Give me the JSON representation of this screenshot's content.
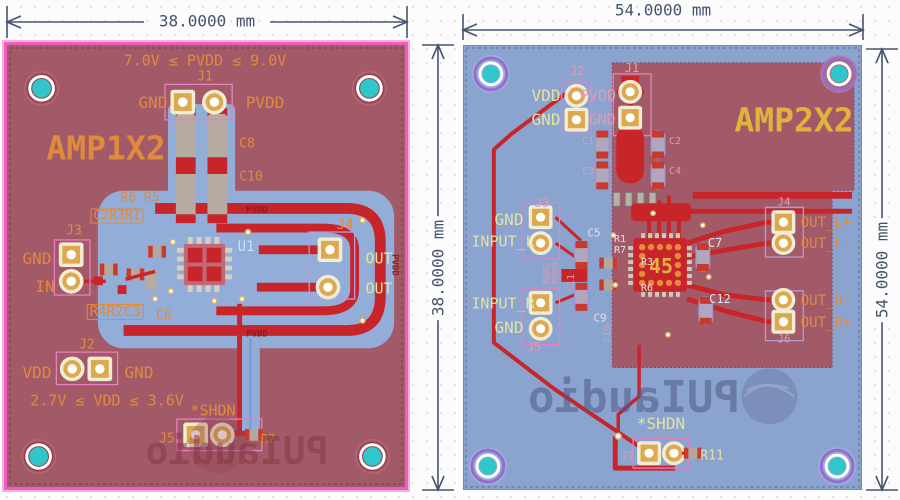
{
  "app": {
    "type": "pcb-layout-viewer"
  },
  "colors": {
    "board_red": "#a35a68",
    "board_blue": "#8ba3cf",
    "outline_pink": "#ee5ec2",
    "copper_red": "#c8252b",
    "pour_blue": "#93add9",
    "hole_teal": "#2fc7c9",
    "ring_purple": "#9a6ad0",
    "pad_gold": "#dca94f",
    "pad_ring": "#f2ecd6",
    "silk_orange": "#e08a3e",
    "silk_yellow": "#e3e3a2",
    "silk_pink": "#dc9cb4",
    "silk_pale": "#e2e2e6",
    "silk_gold": "#e2b23f",
    "net_red": "#8c1d22",
    "dim": "#44546e",
    "logo_left": "rgba(130,52,64,0.5)",
    "logo_right": "rgba(78,90,130,0.55)"
  },
  "logo": {
    "text": "PUIaudio"
  },
  "left_board": {
    "title": "AMP1X2",
    "width_label": "38.0000 mm",
    "height_label": "38.0000 mm",
    "labels": [
      {
        "name": "silk-pvdd-range",
        "text": "7.0V ≤ PVDD ≤ 9.0V",
        "x": 198,
        "y": 16,
        "cls": "silk-orange",
        "size": 15
      },
      {
        "name": "silk-j1",
        "text": "J1",
        "x": 198,
        "y": 32,
        "cls": "silk-orange",
        "size": 13
      },
      {
        "name": "silk-j1-gnd",
        "text": "GND",
        "x": 146,
        "y": 58,
        "cls": "silk-orange",
        "size": 16
      },
      {
        "name": "silk-j1-pvdd",
        "text": "PVDD",
        "x": 258,
        "y": 58,
        "cls": "silk-orange",
        "size": 16
      },
      {
        "name": "silk-c8",
        "text": "C8",
        "x": 240,
        "y": 99,
        "cls": "silk-orange",
        "size": 13
      },
      {
        "name": "silk-c10",
        "text": "C10",
        "x": 244,
        "y": 132,
        "cls": "silk-orange",
        "size": 13
      },
      {
        "name": "board-title",
        "text": "AMP1X2",
        "x": 99,
        "y": 103,
        "cls": "silk-orange",
        "size": 33,
        "bold": true
      },
      {
        "name": "silk-r6-r5",
        "text": "R6 R5",
        "x": 133,
        "y": 153,
        "cls": "silk-orange",
        "size": 13
      },
      {
        "name": "silk-c2r3r1",
        "text": "C2R3R1",
        "x": 110,
        "y": 171,
        "cls": "silk-orange",
        "size": 13,
        "box": true
      },
      {
        "name": "silk-j3",
        "text": "J3",
        "x": 67,
        "y": 186,
        "cls": "silk-orange",
        "size": 13
      },
      {
        "name": "silk-j3-gnd",
        "text": "GND",
        "x": 30,
        "y": 214,
        "cls": "silk-orange",
        "size": 16
      },
      {
        "name": "silk-j3-in",
        "text": "IN",
        "x": 38,
        "y": 242,
        "cls": "silk-orange",
        "size": 16
      },
      {
        "name": "silk-r4r2c3",
        "text": "R4R2C3",
        "x": 108,
        "y": 267,
        "cls": "silk-orange",
        "size": 14,
        "box": true
      },
      {
        "name": "silk-c6",
        "text": "C6",
        "x": 157,
        "y": 271,
        "cls": "silk-orange",
        "size": 13
      },
      {
        "name": "silk-u1",
        "text": "U1",
        "x": 239,
        "y": 202,
        "cls": "silk-blue",
        "size": 14
      },
      {
        "name": "silk-j4",
        "text": "J4",
        "x": 338,
        "y": 180,
        "cls": "silk-orange",
        "size": 14
      },
      {
        "name": "silk-out-1",
        "text": "OUT",
        "x": 372,
        "y": 214,
        "cls": "silk-yellow",
        "size": 15
      },
      {
        "name": "silk-out-2",
        "text": "OUT",
        "x": 372,
        "y": 244,
        "cls": "silk-yellow",
        "size": 15
      },
      {
        "name": "net-pvdd-top",
        "text": "PVDD",
        "x": 250,
        "y": 166,
        "cls": "silk-net",
        "size": 9
      },
      {
        "name": "net-pvdd-bottom",
        "text": "PVDD",
        "x": 250,
        "y": 290,
        "cls": "silk-net",
        "size": 9
      },
      {
        "name": "net-pvdd-right",
        "text": "PVDD",
        "x": 387,
        "y": 220,
        "cls": "silk-net",
        "size": 9,
        "rot": 90
      },
      {
        "name": "silk-j2",
        "text": "J2",
        "x": 80,
        "y": 300,
        "cls": "silk-orange",
        "size": 13
      },
      {
        "name": "silk-j2-vdd",
        "text": "VDD",
        "x": 30,
        "y": 328,
        "cls": "silk-orange",
        "size": 16
      },
      {
        "name": "silk-j2-gnd",
        "text": "GND",
        "x": 132,
        "y": 328,
        "cls": "silk-orange",
        "size": 16
      },
      {
        "name": "silk-vdd-range",
        "text": "2.7V ≤ VDD ≤ 3.6V",
        "x": 100,
        "y": 356,
        "cls": "silk-orange",
        "size": 15
      },
      {
        "name": "silk-shdn",
        "text": "*SHDN",
        "x": 206,
        "y": 366,
        "cls": "silk-orange",
        "size": 15
      },
      {
        "name": "silk-j5",
        "text": "J5",
        "x": 160,
        "y": 394,
        "cls": "silk-orange",
        "size": 13
      },
      {
        "name": "silk-r7",
        "text": "R7",
        "x": 261,
        "y": 394,
        "cls": "silk-orange",
        "size": 12
      },
      {
        "name": "logo-text",
        "text": "PUIaudio",
        "x": 230,
        "y": 406,
        "cls": "logo-left",
        "size": 38,
        "bold": true,
        "mirror": true
      }
    ]
  },
  "right_board": {
    "title": "AMP2X2",
    "width_label": "54.0000 mm",
    "height_label": "54.0000 mm",
    "labels": [
      {
        "name": "silk-j2",
        "text": "J2",
        "x": 113,
        "y": 25,
        "cls": "silk-pink",
        "size": 12
      },
      {
        "name": "silk-j2-vdd",
        "text": "VDD",
        "x": 82,
        "y": 50,
        "cls": "silk-yellow",
        "size": 16
      },
      {
        "name": "silk-j2-gnd",
        "text": "GND",
        "x": 82,
        "y": 74,
        "cls": "silk-yellow",
        "size": 16
      },
      {
        "name": "silk-j1-pvdd",
        "text": "PVDD",
        "x": 134,
        "y": 50,
        "cls": "silk-pink",
        "size": 15
      },
      {
        "name": "silk-j1-gnd",
        "text": "GND",
        "x": 138,
        "y": 74,
        "cls": "silk-pink",
        "size": 15
      },
      {
        "name": "silk-j1",
        "text": "J1",
        "x": 168,
        "y": 22,
        "cls": "silk-pink",
        "size": 12
      },
      {
        "name": "silk-c1",
        "text": "C1",
        "x": 124,
        "y": 96,
        "cls": "silk-pink",
        "size": 10
      },
      {
        "name": "silk-c2",
        "text": "C2",
        "x": 211,
        "y": 96,
        "cls": "silk-pink",
        "size": 10
      },
      {
        "name": "silk-c3",
        "text": "C3",
        "x": 124,
        "y": 126,
        "cls": "silk-pink",
        "size": 10
      },
      {
        "name": "silk-c4",
        "text": "C4",
        "x": 211,
        "y": 126,
        "cls": "silk-pink",
        "size": 10
      },
      {
        "name": "board-title",
        "text": "AMP2X2",
        "x": 330,
        "y": 74,
        "cls": "silk-gold",
        "size": 33,
        "bold": true
      },
      {
        "name": "silk-j3",
        "text": "J3",
        "x": 78,
        "y": 157,
        "cls": "silk-pink",
        "size": 12
      },
      {
        "name": "silk-j3-gnd",
        "text": "GND",
        "x": 45,
        "y": 174,
        "cls": "silk-yellow",
        "size": 16
      },
      {
        "name": "silk-input-l",
        "text": "INPUT_L",
        "x": 39,
        "y": 196,
        "cls": "silk-yellow",
        "size": 15
      },
      {
        "name": "silk-input-r",
        "text": "INPUT_R",
        "x": 39,
        "y": 258,
        "cls": "silk-yellow",
        "size": 15
      },
      {
        "name": "silk-j5-gnd",
        "text": "GND",
        "x": 45,
        "y": 282,
        "cls": "silk-yellow",
        "size": 16
      },
      {
        "name": "silk-j5",
        "text": "J5",
        "x": 70,
        "y": 301,
        "cls": "silk-pink",
        "size": 12
      },
      {
        "name": "silk-r8r2",
        "text": "R8R2",
        "x": 84,
        "y": 227,
        "cls": "silk-pink",
        "size": 9,
        "rot": -90
      },
      {
        "name": "silk-r5r9",
        "text": "R5R9",
        "x": 93,
        "y": 227,
        "cls": "silk-pink",
        "size": 9,
        "rot": -90
      },
      {
        "name": "silk-c5",
        "text": "C5",
        "x": 130,
        "y": 187,
        "cls": "silk-pale",
        "size": 11
      },
      {
        "name": "silk-r1",
        "text": "R1",
        "x": 156,
        "y": 194,
        "cls": "silk-pale",
        "size": 10
      },
      {
        "name": "silk-r7",
        "text": "R7",
        "x": 156,
        "y": 205,
        "cls": "silk-pale",
        "size": 10
      },
      {
        "name": "silk-r3",
        "text": "R3",
        "x": 183,
        "y": 217,
        "cls": "silk-pale",
        "size": 10
      },
      {
        "name": "silk-r6",
        "text": "R6",
        "x": 183,
        "y": 243,
        "cls": "silk-pale",
        "size": 10
      },
      {
        "name": "silk-c9",
        "text": "C9",
        "x": 136,
        "y": 272,
        "cls": "silk-pale",
        "size": 11
      },
      {
        "name": "silk-c11",
        "text": "C11",
        "x": 108,
        "y": 237,
        "cls": "silk-pink",
        "size": 10,
        "rot": -90
      },
      {
        "name": "silk-c10",
        "text": "C10",
        "x": 144,
        "y": 288,
        "cls": "silk-pink",
        "size": 10,
        "rot": -90
      },
      {
        "name": "chip-ref",
        "text": "45",
        "x": 197,
        "y": 220,
        "cls": "silk-gold",
        "size": 20,
        "bold": true
      },
      {
        "name": "silk-c7",
        "text": "C7",
        "x": 251,
        "y": 197,
        "cls": "silk-pale",
        "size": 12
      },
      {
        "name": "silk-c12",
        "text": "C12",
        "x": 256,
        "y": 253,
        "cls": "silk-pale",
        "size": 12
      },
      {
        "name": "silk-j4",
        "text": "J4",
        "x": 320,
        "y": 156,
        "cls": "silk-pink",
        "size": 11
      },
      {
        "name": "silk-out-l-plus",
        "text": "OUT_L+",
        "x": 362,
        "y": 177,
        "cls": "silk-orange",
        "size": 14
      },
      {
        "name": "silk-out-l-minus",
        "text": "OUT_L-",
        "x": 362,
        "y": 198,
        "cls": "silk-orange",
        "size": 14
      },
      {
        "name": "silk-out-r-minus",
        "text": "OUT_R-",
        "x": 362,
        "y": 255,
        "cls": "silk-orange",
        "size": 14
      },
      {
        "name": "silk-out-r-plus",
        "text": "OUT_R+",
        "x": 362,
        "y": 277,
        "cls": "silk-orange",
        "size": 14
      },
      {
        "name": "silk-j6",
        "text": "J6",
        "x": 320,
        "y": 293,
        "cls": "silk-pink",
        "size": 11
      },
      {
        "name": "silk-shdn",
        "text": "*SHDN",
        "x": 197,
        "y": 378,
        "cls": "silk-yellow",
        "size": 16
      },
      {
        "name": "silk-j7",
        "text": "J7",
        "x": 164,
        "y": 410,
        "cls": "silk-pink",
        "size": 11
      },
      {
        "name": "silk-r11",
        "text": "R11",
        "x": 248,
        "y": 410,
        "cls": "silk-yellow",
        "size": 13
      },
      {
        "name": "logo-text",
        "text": "PUIaudio",
        "x": 170,
        "y": 352,
        "cls": "logo-right",
        "size": 44,
        "bold": true,
        "mirror": true
      }
    ]
  }
}
